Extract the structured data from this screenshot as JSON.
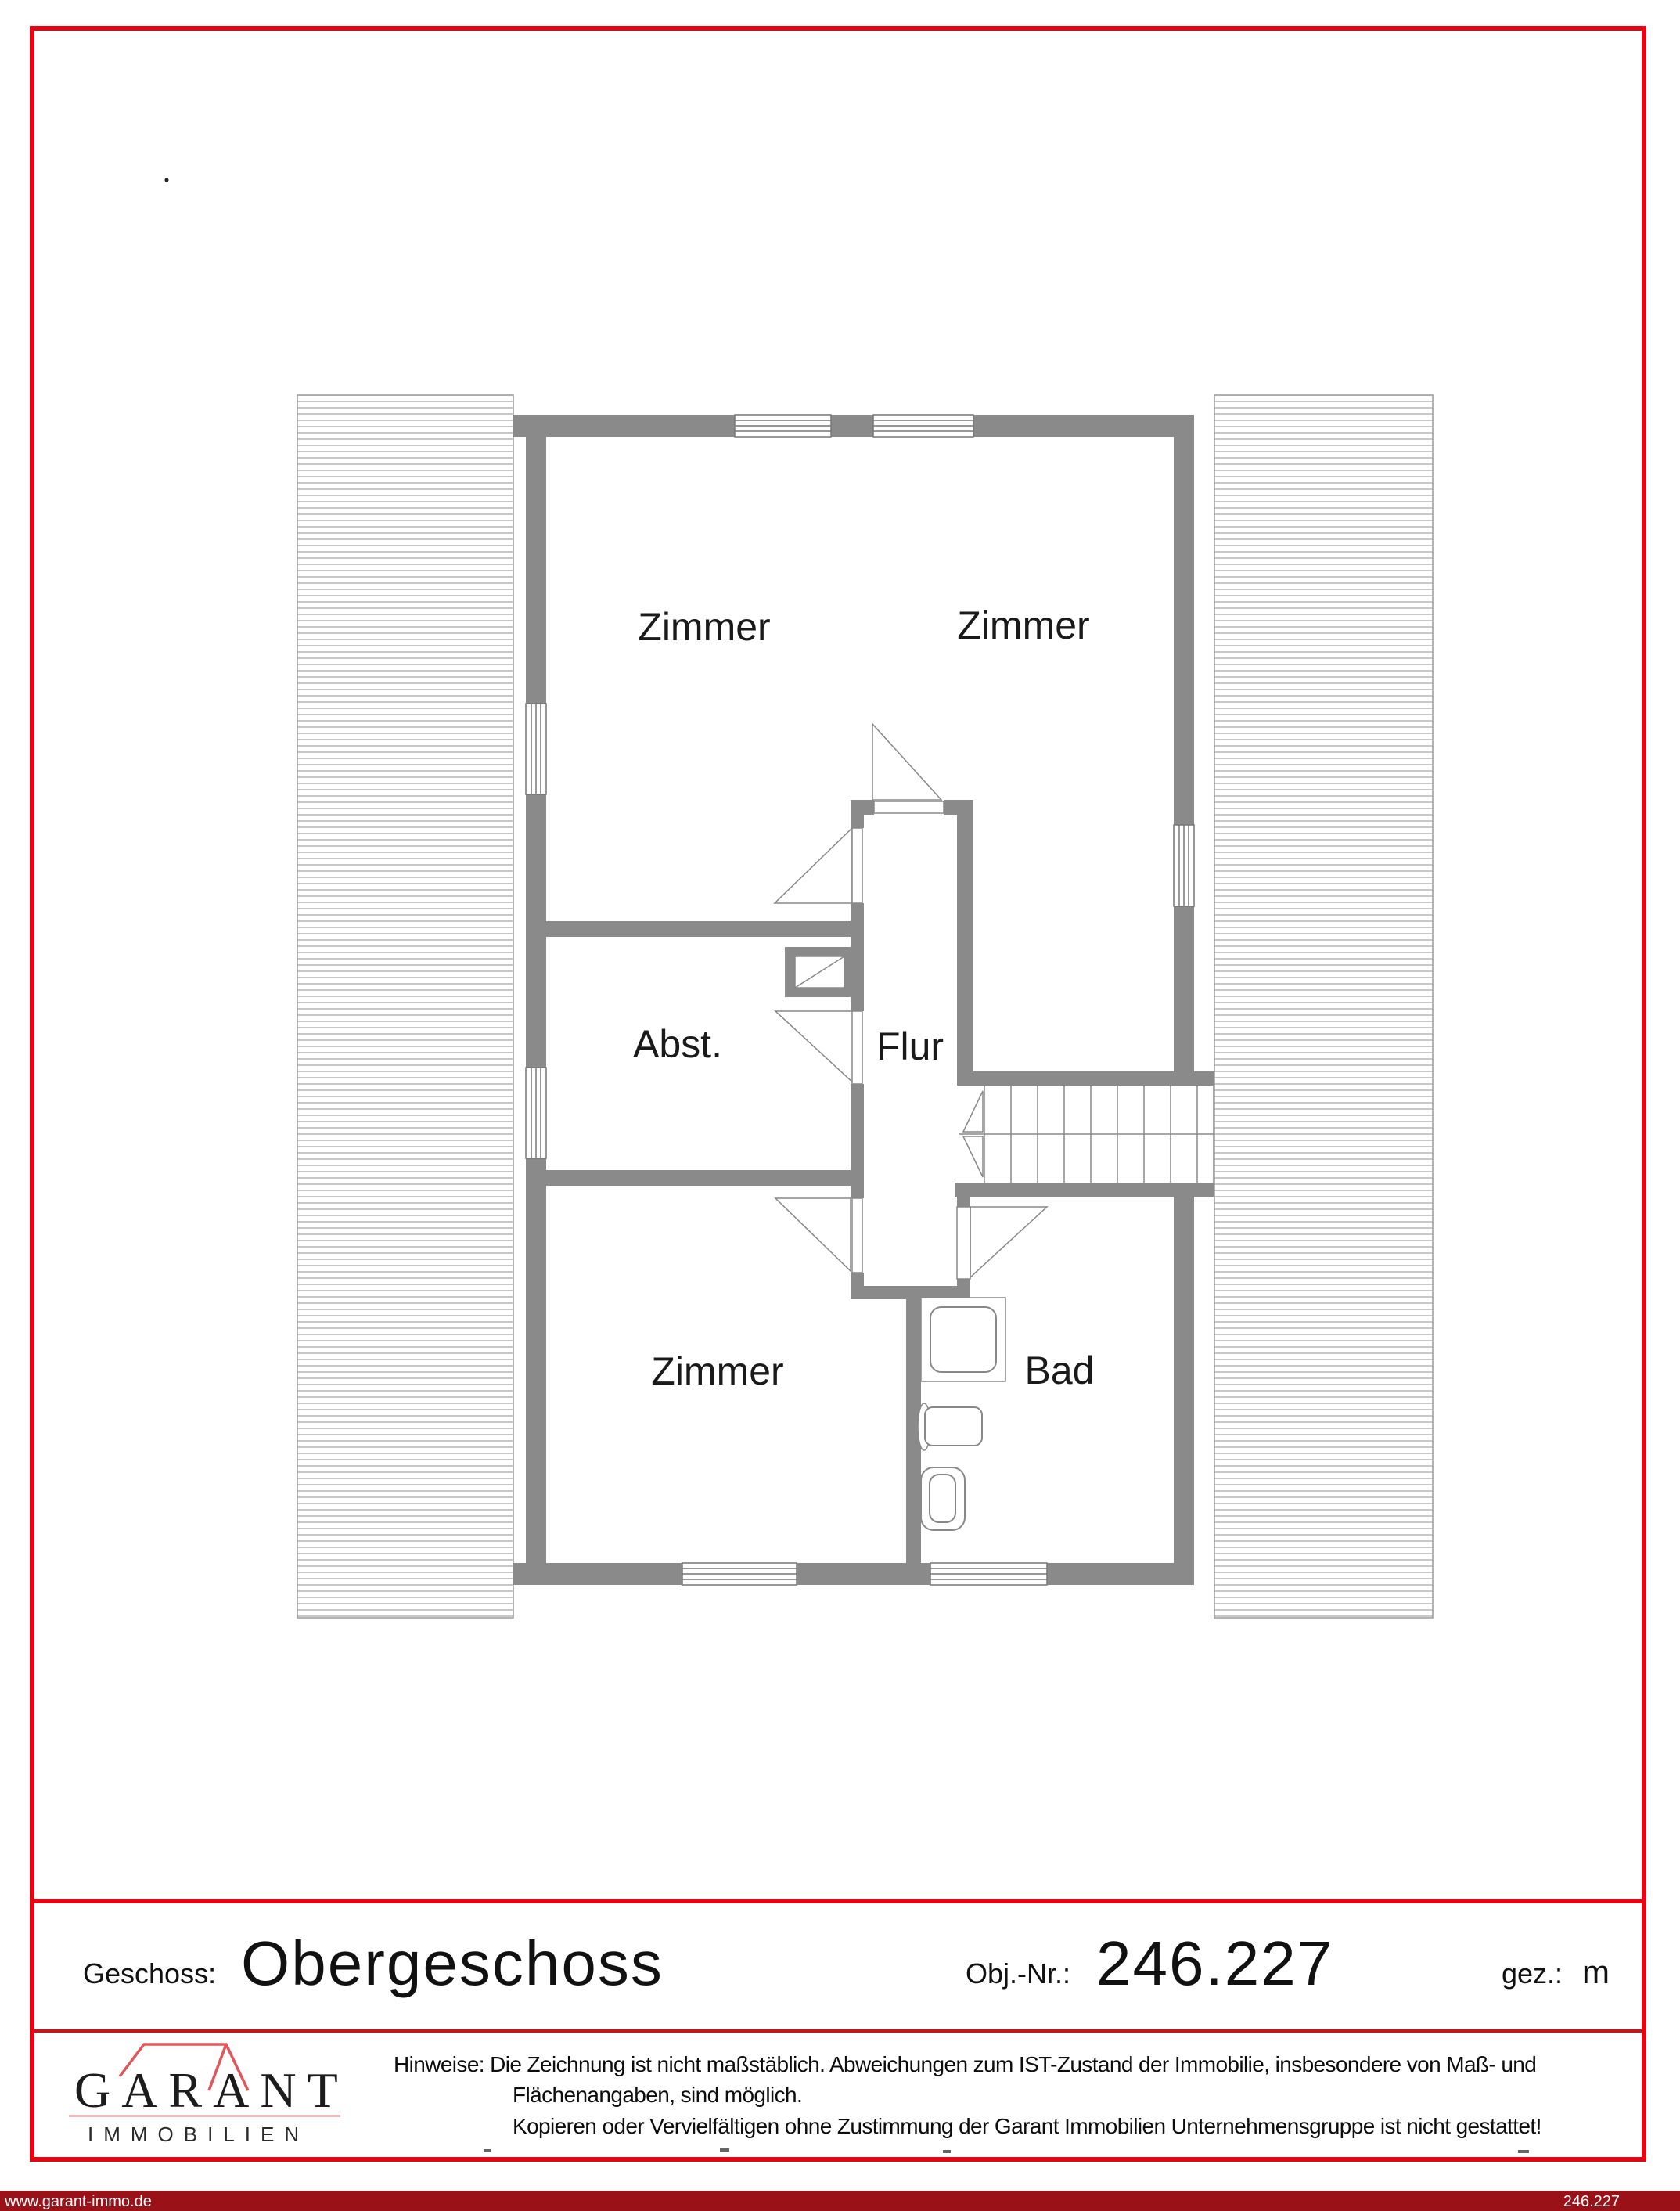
{
  "floor_plan": {
    "rooms": {
      "zimmer_top_left": "Zimmer",
      "zimmer_top_right": "Zimmer",
      "abstellraum": "Abst.",
      "flur": "Flur",
      "zimmer_bottom": "Zimmer",
      "bad": "Bad"
    },
    "symbols": [
      "window-symbol",
      "door-swing-symbol",
      "stairs-symbol",
      "chimney-symbol",
      "shower-symbol",
      "sink-symbol",
      "toilet-symbol",
      "roof-hatch-area"
    ]
  },
  "footer": {
    "geschoss_label": "Geschoss:",
    "geschoss_value": "Obergeschoss",
    "obj_label": "Obj.-Nr.:",
    "obj_value": "246.227",
    "gez_label": "gez.:",
    "gez_value": "m"
  },
  "logo": {
    "brand": "GARANT",
    "brand_sub": "IMMOBILIEN"
  },
  "notice": {
    "line1": "Hinweise: Die Zeichnung ist nicht maßstäblich. Abweichungen zum IST-Zustand der Immobilie, insbesondere von Maß- und",
    "line2": "Flächenangaben, sind möglich.",
    "line3": "Kopieren oder Vervielfältigen ohne Zustimmung der Garant Immobilien Unternehmensgruppe ist nicht gestattet!"
  },
  "bottom_bar": {
    "website": "www.garant-immo.de",
    "object_number": "246.227"
  },
  "colors": {
    "frame_red": "#e30613",
    "bar_maroon": "#9a1117",
    "wall_gray": "#8a8a8a",
    "line_gray": "#888888",
    "logo_roof_red": "#e0565b",
    "logo_underline_pink": "#f2b9bb"
  }
}
